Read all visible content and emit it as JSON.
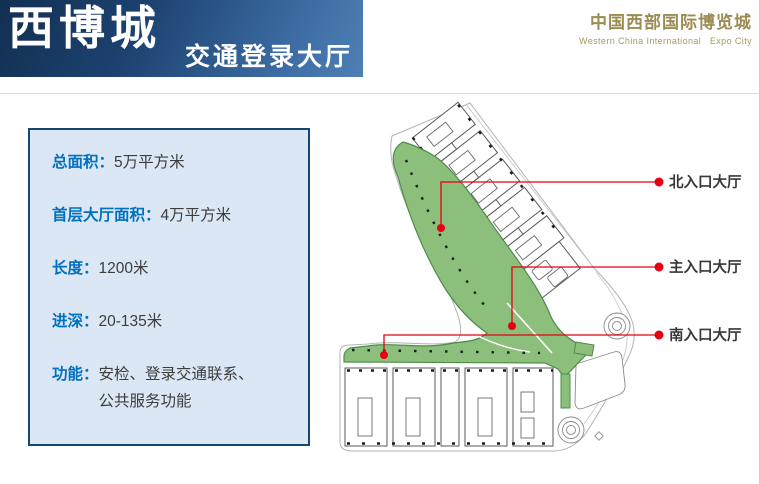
{
  "header": {
    "title": "西博城",
    "subtitle": "交通登录大厅",
    "logo_cn": "中国西部国际博览城",
    "logo_en": "Western China International   Expo City",
    "banner_gradient": [
      "#122f51",
      "#4f80b5"
    ],
    "logo_color": "#9c8c52"
  },
  "info_panel": {
    "bg_color": "#dbe7f4",
    "border_color": "#17466e",
    "label_color": "#0070c0",
    "value_color": "#3d3d3d",
    "items": [
      {
        "label": "总面积：",
        "value": "5万平方米"
      },
      {
        "label": "首层大厅面积：",
        "value": "4万平方米"
      },
      {
        "label": "长度：",
        "value": "1200米"
      },
      {
        "label": "进深：",
        "value": "20-135米"
      },
      {
        "label": "功能：",
        "value": "安检、登录交通联系、公共服务功能"
      }
    ]
  },
  "plan": {
    "concourse_fill": "#8cbf7c",
    "concourse_stroke": "#4e8c4a",
    "leader_color": "#e60012",
    "labels": {
      "north": "北入口大厅",
      "main": "主入口大厅",
      "south": "南入口大厅"
    }
  }
}
